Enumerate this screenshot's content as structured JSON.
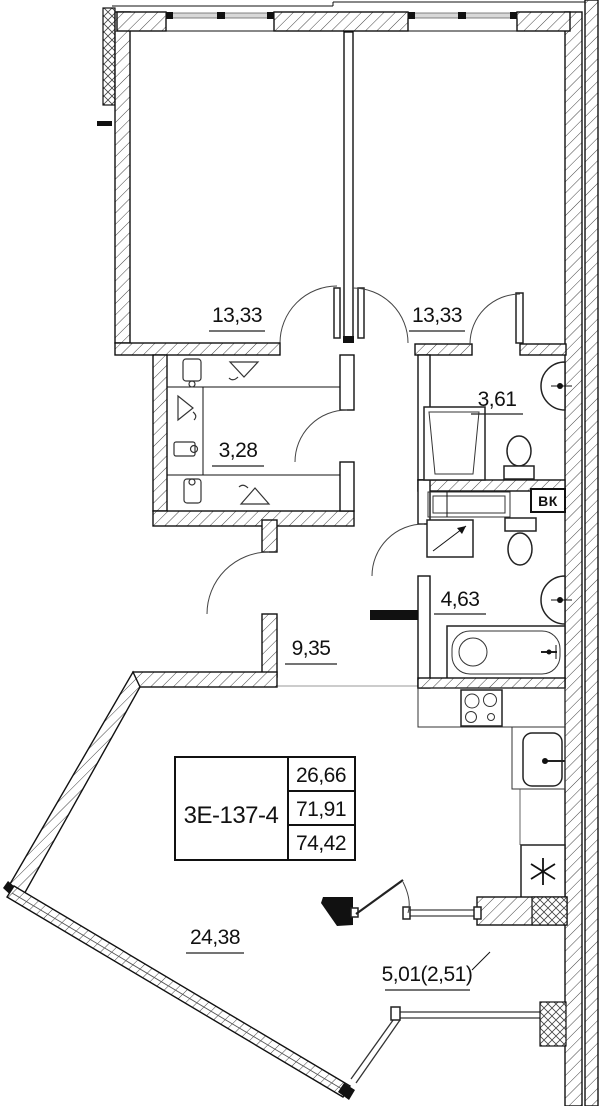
{
  "plan": {
    "unit_code": "3Е-137-4",
    "info_box": {
      "living_area": "26,66",
      "apartment_area": "71,91",
      "total_area": "74,42"
    },
    "rooms": {
      "bedroom_left": {
        "area": "13,33"
      },
      "bedroom_right": {
        "area": "13,33"
      },
      "wardrobe": {
        "area": "3,28"
      },
      "bathroom_ensuite": {
        "area": "3,61"
      },
      "bathroom_main": {
        "area": "4,63"
      },
      "hallway": {
        "area": "9,35"
      },
      "living_kitchen": {
        "area": "24,38"
      },
      "balcony": {
        "area": "5,01(2,51)"
      }
    },
    "duct_label": "ВК"
  }
}
